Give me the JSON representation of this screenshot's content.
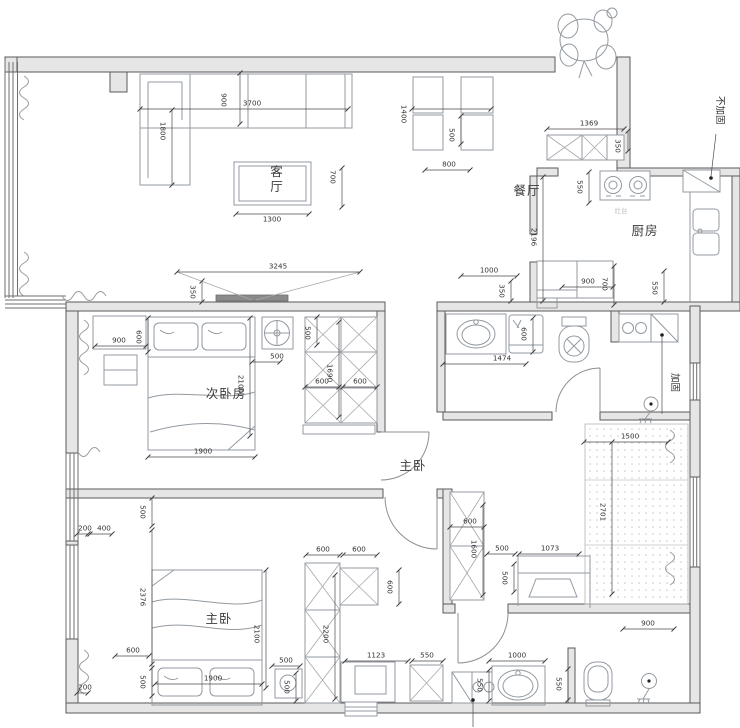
{
  "document": {
    "type": "residential floor plan",
    "units": "mm"
  },
  "colors": {
    "background": "#ffffff",
    "wall_fill": "#e6e6e6",
    "wall_line": "#5a5a5a",
    "dim_line": "#4a4a4a",
    "dim_text": "#333333",
    "furniture_line": "#939aa0"
  },
  "rooms": [
    {
      "label": "客厅",
      "x": 277,
      "y": 176,
      "vertical": true
    },
    {
      "label": "餐厅",
      "x": 527,
      "y": 191,
      "vertical": false
    },
    {
      "label": "厨房",
      "x": 645,
      "y": 231,
      "vertical": false
    },
    {
      "label": "次卧房",
      "x": 226,
      "y": 394,
      "vertical": false
    },
    {
      "label": "主卧",
      "x": 413,
      "y": 466,
      "vertical": false
    },
    {
      "label": "主卧",
      "x": 219,
      "y": 619,
      "vertical": false
    }
  ],
  "annotations": [
    {
      "label": "不加固",
      "x": 717,
      "y": 96,
      "vertical": true,
      "leader": [
        716,
        134,
        711,
        176
      ],
      "dot": [
        711,
        178
      ]
    },
    {
      "label": "加固",
      "x": 672,
      "y": 373,
      "vertical": true,
      "leader": [
        662,
        337,
        662,
        414
      ],
      "dot": [
        662,
        335
      ]
    },
    {
      "label": "灶台",
      "x": 621,
      "y": 213,
      "faint": true
    },
    {
      "label": "",
      "leader": [
        473,
        701,
        473,
        727
      ],
      "dot": [
        473,
        700
      ]
    }
  ],
  "dimensions": [
    {
      "v": "900",
      "x": 224,
      "y": 100,
      "r": 90,
      "l": [
        240,
        73,
        240,
        124
      ]
    },
    {
      "v": "3700",
      "x": 252,
      "y": 103,
      "r": 0,
      "l": [
        140,
        109,
        348,
        109
      ]
    },
    {
      "v": "1800",
      "x": 163,
      "y": 131,
      "r": 90,
      "l": [
        172,
        110,
        172,
        185
      ]
    },
    {
      "v": "1400",
      "x": 404,
      "y": 114,
      "r": 90,
      "l": [
        412,
        109,
        491,
        109
      ]
    },
    {
      "v": "500",
      "x": 452,
      "y": 135,
      "r": 90,
      "l": [
        461,
        116,
        461,
        144
      ]
    },
    {
      "v": "800",
      "x": 449,
      "y": 164,
      "r": 0,
      "l": [
        425,
        170,
        470,
        170
      ]
    },
    {
      "v": "1369",
      "x": 589,
      "y": 123,
      "r": 0,
      "l": [
        547,
        129,
        624,
        129
      ]
    },
    {
      "v": "350",
      "x": 618,
      "y": 146,
      "r": 90,
      "l": [
        628,
        131,
        628,
        151
      ]
    },
    {
      "v": "550",
      "x": 580,
      "y": 187,
      "r": 90,
      "l": [
        589,
        172,
        589,
        203
      ]
    },
    {
      "v": "2196",
      "x": 534,
      "y": 237,
      "r": 90,
      "l": [
        543,
        177,
        543,
        301
      ]
    },
    {
      "v": "550",
      "x": 655,
      "y": 288,
      "r": 90,
      "l": [
        664,
        271,
        664,
        302
      ]
    },
    {
      "v": "900",
      "x": 588,
      "y": 281,
      "r": 0,
      "l": [
        562,
        287,
        613,
        287
      ]
    },
    {
      "v": "700",
      "x": 605,
      "y": 284,
      "r": 90,
      "l": [
        614,
        266,
        614,
        305
      ]
    },
    {
      "v": "1000",
      "x": 489,
      "y": 270,
      "r": 0,
      "l": [
        461,
        276,
        517,
        276
      ]
    },
    {
      "v": "350",
      "x": 502,
      "y": 291,
      "r": 90,
      "l": [
        511,
        281,
        511,
        301
      ]
    },
    {
      "v": "3245",
      "x": 278,
      "y": 266,
      "r": 0,
      "l": [
        177,
        272,
        360,
        272
      ]
    },
    {
      "v": "350",
      "x": 193,
      "y": 292,
      "r": 90,
      "l": [
        202,
        281,
        202,
        302
      ]
    },
    {
      "v": "900",
      "x": 119,
      "y": 340,
      "r": 0,
      "l": [
        95,
        346,
        146,
        346
      ]
    },
    {
      "v": "600",
      "x": 139,
      "y": 337,
      "r": 90,
      "l": [
        148,
        318,
        148,
        352
      ]
    },
    {
      "v": "700",
      "x": 333,
      "y": 177,
      "r": 90,
      "l": [
        342,
        168,
        342,
        207
      ]
    },
    {
      "v": "1300",
      "x": 272,
      "y": 219,
      "r": 0,
      "l": [
        236,
        214,
        309,
        214
      ]
    },
    {
      "v": "2100",
      "x": 241,
      "y": 384,
      "r": 90,
      "l": [
        250,
        318,
        250,
        436
      ]
    },
    {
      "v": "500",
      "x": 308,
      "y": 333,
      "r": 90,
      "l": [
        317,
        317,
        317,
        345
      ]
    },
    {
      "v": "500",
      "x": 277,
      "y": 356,
      "r": 0,
      "l": [
        252,
        362,
        280,
        362
      ]
    },
    {
      "v": "1690",
      "x": 330,
      "y": 373,
      "r": 90,
      "l": [
        339,
        322,
        339,
        417
      ]
    },
    {
      "v": "600",
      "x": 322,
      "y": 381,
      "r": 0,
      "l": [
        305,
        387,
        339,
        387
      ]
    },
    {
      "v": "600",
      "x": 360,
      "y": 381,
      "r": 0,
      "l": [
        343,
        387,
        377,
        387
      ]
    },
    {
      "v": "1900",
      "x": 203,
      "y": 451,
      "r": 0,
      "l": [
        148,
        457,
        255,
        457
      ]
    },
    {
      "v": "600",
      "x": 524,
      "y": 334,
      "r": 90,
      "l": [
        533,
        318,
        533,
        352
      ]
    },
    {
      "v": "1474",
      "x": 502,
      "y": 358,
      "r": 0,
      "l": [
        443,
        364,
        526,
        364
      ]
    },
    {
      "v": "1500",
      "x": 630,
      "y": 436,
      "r": 0,
      "l": [
        584,
        442,
        668,
        442
      ]
    },
    {
      "v": "2701",
      "x": 603,
      "y": 512,
      "r": 90,
      "l": [
        612,
        442,
        612,
        594
      ]
    },
    {
      "v": "600",
      "x": 470,
      "y": 521,
      "r": 0,
      "l": [
        450,
        527,
        484,
        527
      ]
    },
    {
      "v": "1600",
      "x": 474,
      "y": 549,
      "r": 90,
      "l": [
        483,
        505,
        483,
        595
      ]
    },
    {
      "v": "500",
      "x": 502,
      "y": 548,
      "r": 0,
      "l": [
        487,
        554,
        515,
        554
      ]
    },
    {
      "v": "1073",
      "x": 550,
      "y": 548,
      "r": 0,
      "l": [
        519,
        554,
        579,
        554
      ]
    },
    {
      "v": "500",
      "x": 505,
      "y": 578,
      "r": 90,
      "l": [
        514,
        564,
        514,
        592
      ]
    },
    {
      "v": "500",
      "x": 143,
      "y": 512,
      "r": 90,
      "l": [
        152,
        498,
        152,
        526
      ]
    },
    {
      "v": "200",
      "x": 85,
      "y": 528,
      "r": 0,
      "l": [
        77,
        534,
        88,
        534
      ]
    },
    {
      "v": "400",
      "x": 104,
      "y": 528,
      "r": 0,
      "l": [
        90,
        534,
        112,
        534
      ]
    },
    {
      "v": "2376",
      "x": 143,
      "y": 597,
      "r": 90,
      "l": [
        152,
        530,
        152,
        664
      ]
    },
    {
      "v": "600",
      "x": 133,
      "y": 650,
      "r": 0,
      "l": [
        115,
        656,
        149,
        656
      ]
    },
    {
      "v": "500",
      "x": 143,
      "y": 682,
      "r": 90,
      "l": [
        152,
        668,
        152,
        696
      ]
    },
    {
      "v": "200",
      "x": 85,
      "y": 687,
      "r": 0,
      "l": [
        77,
        693,
        88,
        693
      ]
    },
    {
      "v": "1900",
      "x": 213,
      "y": 678,
      "r": 0,
      "l": [
        155,
        684,
        262,
        684
      ]
    },
    {
      "v": "2100",
      "x": 257,
      "y": 634,
      "r": 90,
      "l": [
        266,
        570,
        266,
        688
      ]
    },
    {
      "v": "500",
      "x": 286,
      "y": 660,
      "r": 0,
      "l": [
        272,
        666,
        300,
        666
      ]
    },
    {
      "v": "500",
      "x": 287,
      "y": 687,
      "r": 90,
      "l": [
        296,
        673,
        296,
        701
      ]
    },
    {
      "v": "600",
      "x": 323,
      "y": 549,
      "r": 0,
      "l": [
        306,
        555,
        340,
        555
      ]
    },
    {
      "v": "600",
      "x": 359,
      "y": 549,
      "r": 0,
      "l": [
        343,
        555,
        377,
        555
      ]
    },
    {
      "v": "600",
      "x": 390,
      "y": 587,
      "r": 90,
      "l": [
        399,
        570,
        399,
        604
      ]
    },
    {
      "v": "2200",
      "x": 326,
      "y": 634,
      "r": 90,
      "l": [
        335,
        575,
        335,
        699
      ]
    },
    {
      "v": "1123",
      "x": 376,
      "y": 655,
      "r": 0,
      "l": [
        345,
        661,
        408,
        661
      ]
    },
    {
      "v": "550",
      "x": 427,
      "y": 655,
      "r": 0,
      "l": [
        412,
        661,
        443,
        661
      ]
    },
    {
      "v": "550",
      "x": 480,
      "y": 685,
      "r": 90,
      "l": [
        489,
        670,
        489,
        701
      ]
    },
    {
      "v": "1000",
      "x": 517,
      "y": 655,
      "r": 0,
      "l": [
        489,
        661,
        545,
        661
      ]
    },
    {
      "v": "550",
      "x": 559,
      "y": 684,
      "r": 90,
      "l": [
        568,
        669,
        568,
        700
      ]
    },
    {
      "v": "900",
      "x": 648,
      "y": 623,
      "r": 0,
      "l": [
        623,
        629,
        674,
        629
      ]
    }
  ]
}
